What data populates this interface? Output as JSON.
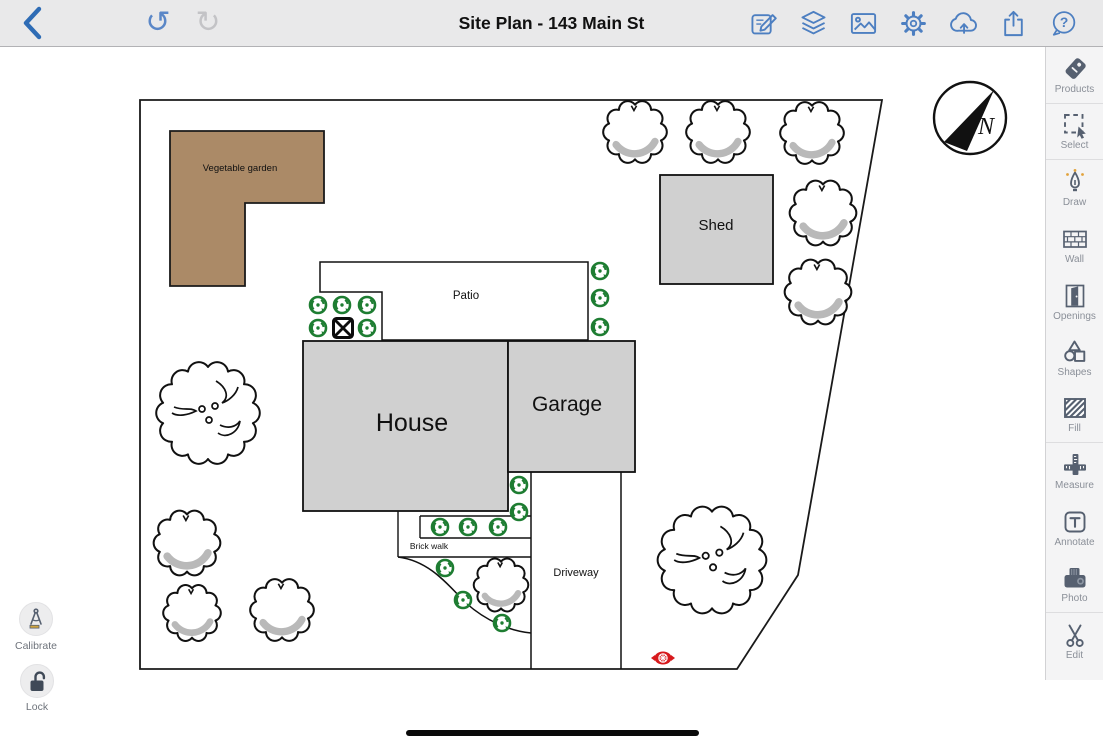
{
  "top_toolbar": {
    "title": "Site Plan - 143 Main St",
    "icons": [
      "back",
      "undo",
      "redo",
      "compose",
      "layers",
      "image",
      "settings",
      "cloud-upload",
      "share",
      "help"
    ]
  },
  "plan": {
    "labels": {
      "vegetable_garden": "Vegetable garden",
      "patio": "Patio",
      "shed": "Shed",
      "house": "House",
      "garage": "Garage",
      "driveway": "Driveway",
      "brick_walk": "Brick walk",
      "compass_north": "N"
    },
    "symbols": [
      "property-boundary",
      "deciduous-tree",
      "shrub-bush",
      "planting-shrub",
      "spa-box",
      "fire-hydrant",
      "north-compass"
    ]
  },
  "sidebar": {
    "tools": [
      {
        "label": "Products",
        "icon": "tag-icon"
      },
      {
        "label": "Select",
        "icon": "marquee-cursor-icon"
      },
      {
        "label": "Draw",
        "icon": "pen-nib-icon"
      },
      {
        "label": "Wall",
        "icon": "brick-wall-icon"
      },
      {
        "label": "Openings",
        "icon": "door-icon"
      },
      {
        "label": "Shapes",
        "icon": "shapes-icon"
      },
      {
        "label": "Fill",
        "icon": "hatch-fill-icon"
      },
      {
        "label": "Measure",
        "icon": "ruler-icon"
      },
      {
        "label": "Annotate",
        "icon": "text-icon"
      },
      {
        "label": "Photo",
        "icon": "camera-icon"
      },
      {
        "label": "Edit",
        "icon": "scissors-icon"
      }
    ]
  },
  "corner_tools": {
    "calibrate_label": "Calibrate",
    "lock_label": "Lock"
  },
  "glyphs": {
    "undo": "↺",
    "redo": "↻",
    "help_mark": "?"
  },
  "colors": {
    "accent_blue": "#4d7fc1",
    "tool_icon_gray": "#566070",
    "garden_brown": "#ab8a67",
    "building_gray": "#d0d0d0",
    "plant_green": "#1e7d32",
    "hydrant_red": "#d7191c"
  }
}
